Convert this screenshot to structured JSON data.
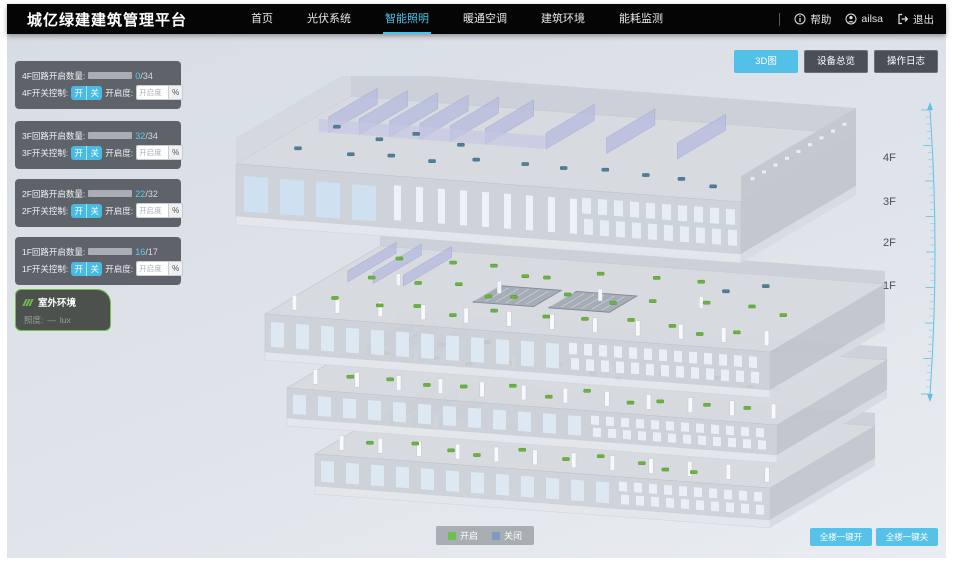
{
  "header": {
    "title": "城亿绿建建筑管理平台",
    "nav": [
      {
        "label": "首页",
        "active": false
      },
      {
        "label": "光伏系统",
        "active": false
      },
      {
        "label": "智能照明",
        "active": true
      },
      {
        "label": "暖通空调",
        "active": false
      },
      {
        "label": "建筑环境",
        "active": false
      },
      {
        "label": "能耗监测",
        "active": false
      }
    ],
    "help_label": "帮助",
    "user_name": "ailsa",
    "logout_label": "退出"
  },
  "view_buttons": [
    {
      "label": "3D图",
      "active": true
    },
    {
      "label": "设备总览",
      "active": false
    },
    {
      "label": "操作日志",
      "active": false
    }
  ],
  "floor_panels": [
    {
      "count_label": "4F回路开启数量:",
      "value": 0,
      "total": 34,
      "total_suffix": "/34",
      "control_label": "4F开关控制:",
      "on_label": "开",
      "off_label": "关",
      "degree_label": "开启度:",
      "degree_placeholder": "开启度",
      "percent_label": "%"
    },
    {
      "count_label": "3F回路开启数量:",
      "value": 32,
      "total": 34,
      "total_suffix": "/34",
      "control_label": "3F开关控制:",
      "on_label": "开",
      "off_label": "关",
      "degree_label": "开启度:",
      "degree_placeholder": "开启度",
      "percent_label": "%"
    },
    {
      "count_label": "2F回路开启数量:",
      "value": 22,
      "total": 32,
      "total_suffix": "/32",
      "control_label": "2F开关控制:",
      "on_label": "开",
      "off_label": "关",
      "degree_label": "开启度:",
      "degree_placeholder": "开启度",
      "percent_label": "%"
    },
    {
      "count_label": "1F回路开启数量:",
      "value": 16,
      "total": 17,
      "total_suffix": "/17",
      "control_label": "1F开关控制:",
      "on_label": "开",
      "off_label": "关",
      "degree_label": "开启度:",
      "degree_placeholder": "开启度",
      "percent_label": "%"
    }
  ],
  "outdoor_panel": {
    "title": "室外环境",
    "metric_label": "照度:",
    "metric_value": "—",
    "metric_unit": "lux"
  },
  "floor_labels": [
    "4F",
    "3F",
    "2F",
    "1F"
  ],
  "building": {
    "floors": [
      {
        "label": "4F",
        "lights_on": 0,
        "lights_off": 15
      },
      {
        "label": "3F",
        "lights_on": 30,
        "lights_off": 2
      },
      {
        "label": "2F",
        "lights_on": 24,
        "lights_off": 1
      },
      {
        "label": "1F",
        "lights_on": 10,
        "lights_off": 0
      }
    ]
  },
  "legend": {
    "on_label": "开启",
    "off_label": "关闭",
    "on_color": "#6fbf4a",
    "off_color": "#7f9bbf"
  },
  "bulk_buttons": [
    {
      "label": "全楼一键开"
    },
    {
      "label": "全楼一键关"
    }
  ],
  "colors": {
    "accent": "#4ec3ea",
    "light_on": "#6ab33e",
    "light_off": "#4e7f98"
  }
}
